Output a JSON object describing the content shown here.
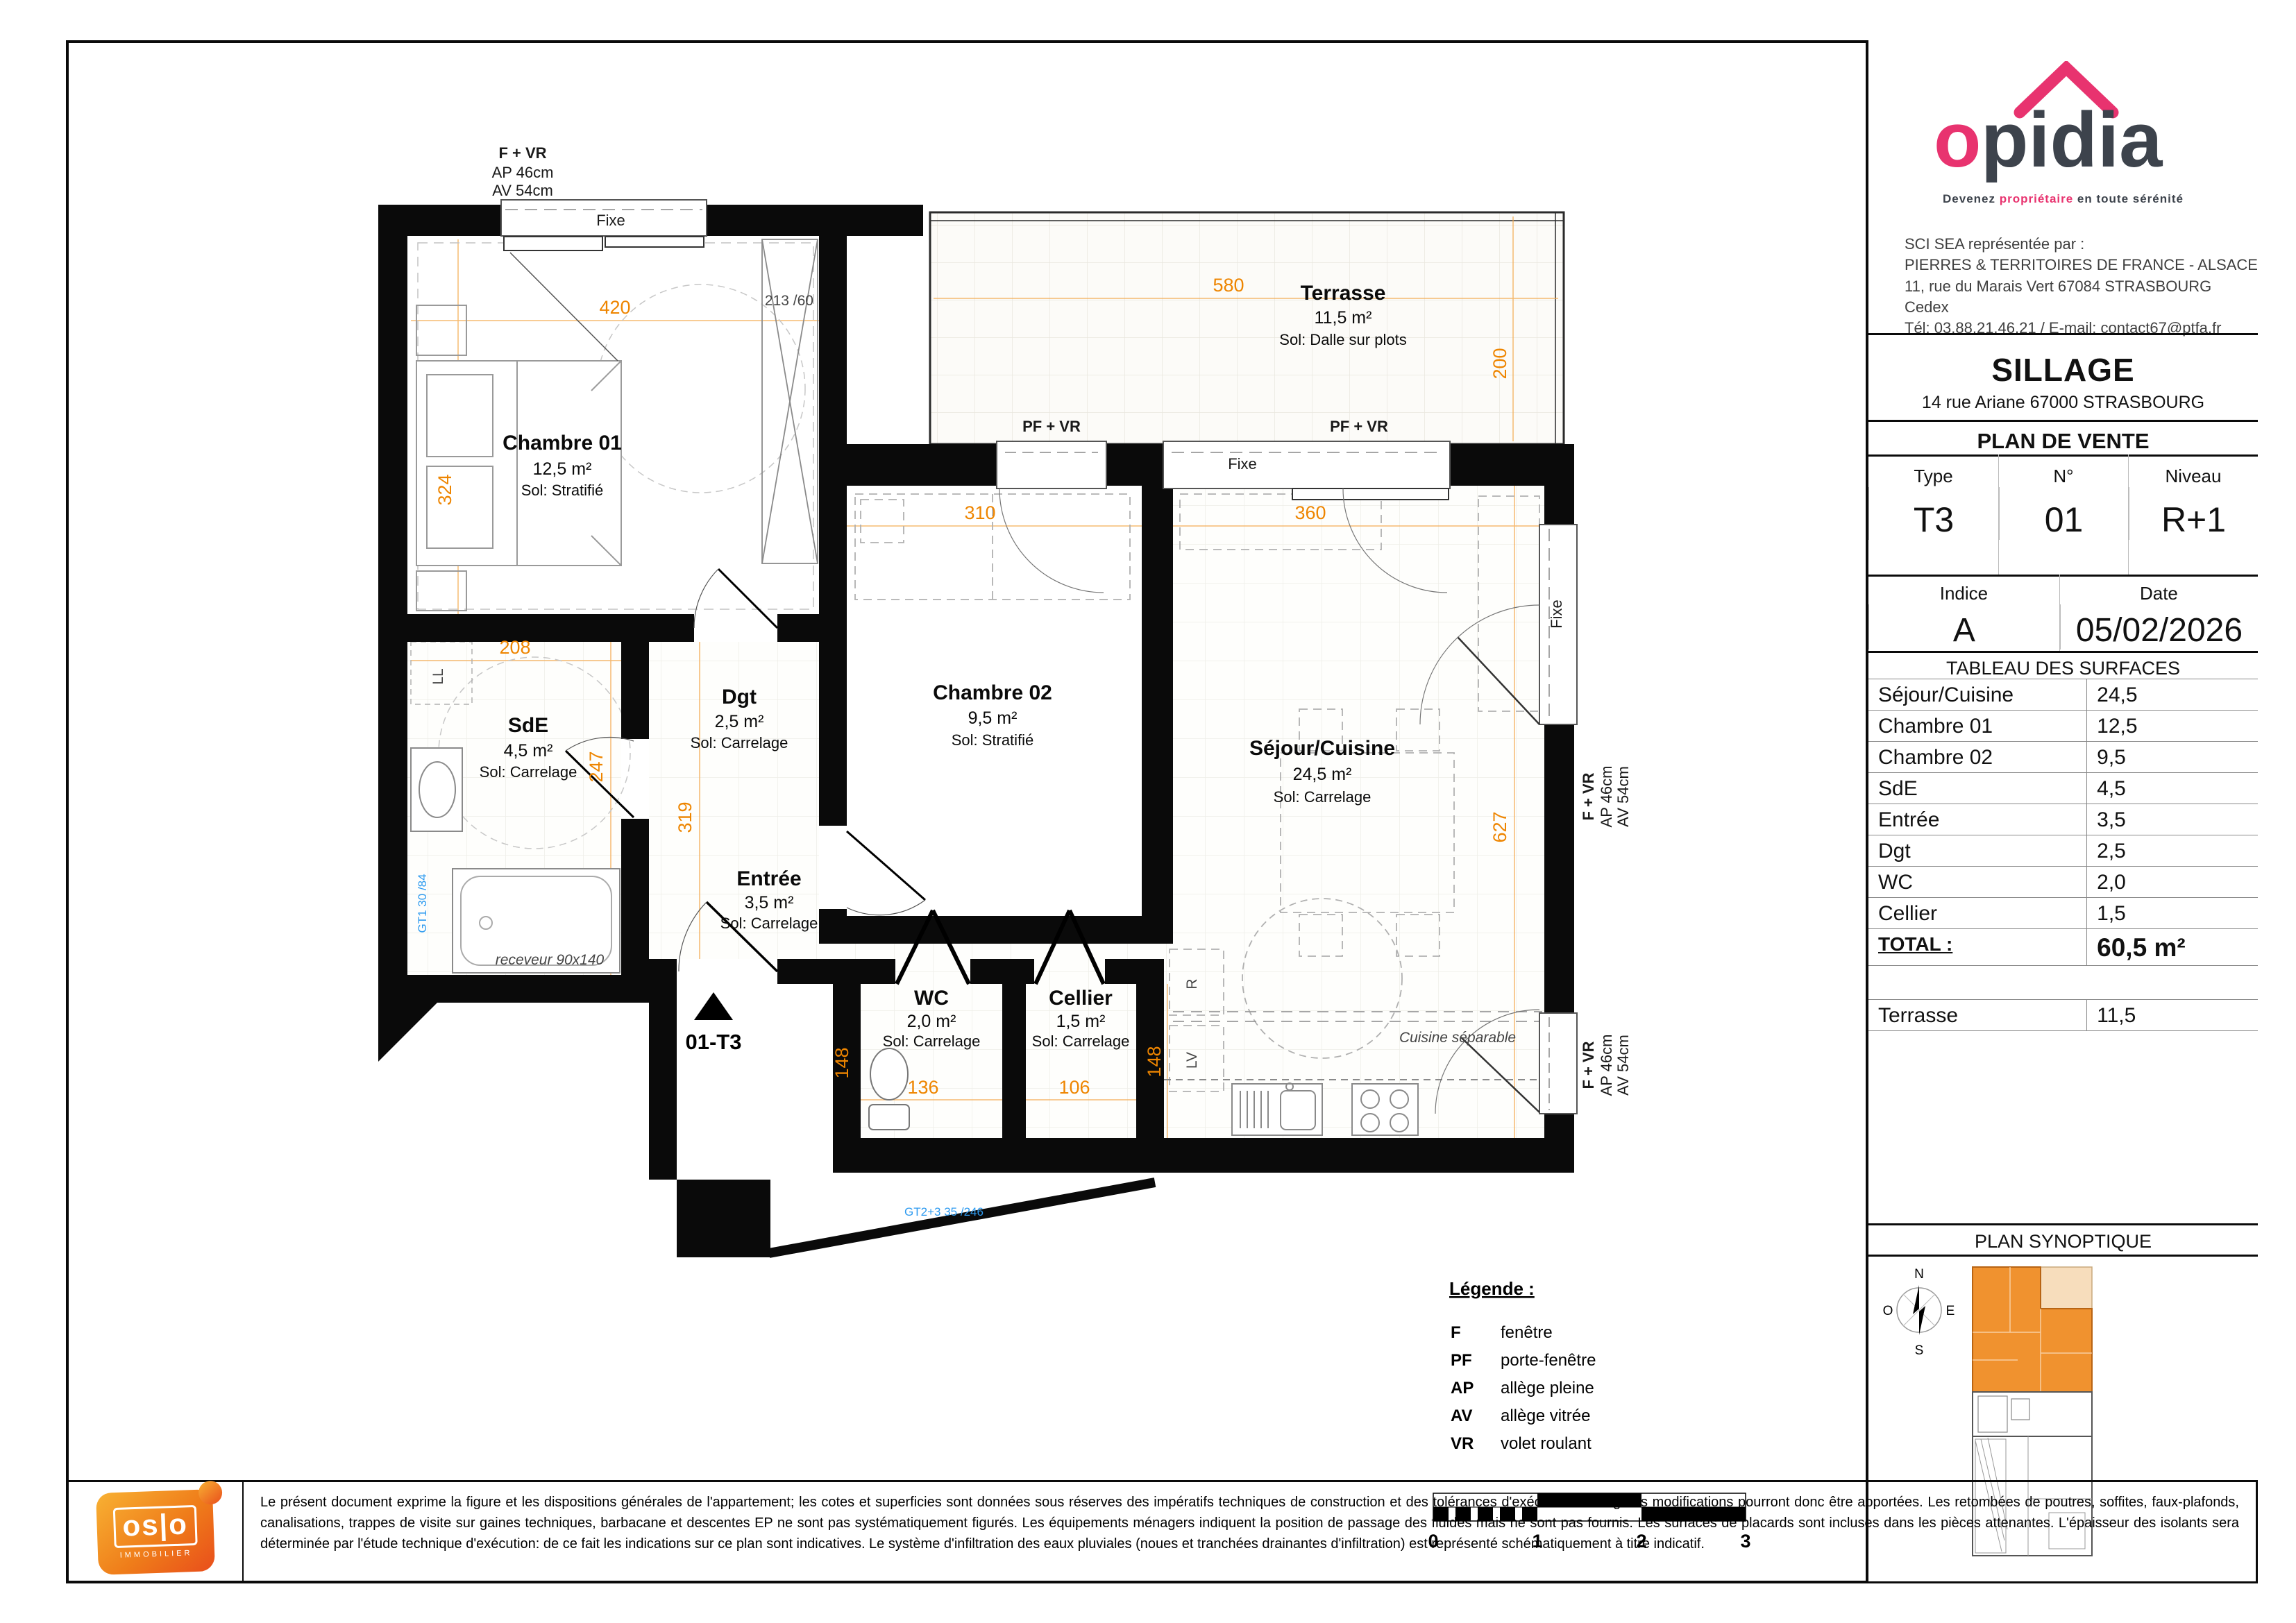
{
  "plan": {
    "window_top": {
      "title": "F + VR",
      "l1": "AP 46cm",
      "l2": "AV 54cm"
    },
    "window_right1": {
      "title": "F + VR",
      "l1": "AP 46cm",
      "l2": "AV 54cm"
    },
    "window_right2": {
      "title": "F + VR",
      "l1": "AP 46cm",
      "l2": "AV 54cm"
    },
    "fixe1": "Fixe",
    "fixe2": "Fixe",
    "fixe3": "Fixe",
    "pf1": "PF + VR",
    "pf2": "PF + VR",
    "rooms": {
      "chambre01": {
        "name": "Chambre 01",
        "area": "12,5 m²",
        "floor": "Sol: Stratifié"
      },
      "chambre02": {
        "name": "Chambre 02",
        "area": "9,5 m²",
        "floor": "Sol: Stratifié"
      },
      "sejour": {
        "name": "Séjour/Cuisine",
        "area": "24,5 m²",
        "floor": "Sol: Carrelage"
      },
      "sde": {
        "name": "SdE",
        "area": "4,5 m²",
        "floor": "Sol: Carrelage"
      },
      "dgt": {
        "name": "Dgt",
        "area": "2,5 m²",
        "floor": "Sol: Carrelage"
      },
      "entree": {
        "name": "Entrée",
        "area": "3,5 m²",
        "floor": "Sol: Carrelage"
      },
      "wc": {
        "name": "WC",
        "area": "2,0 m²",
        "floor": "Sol: Carrelage"
      },
      "cellier": {
        "name": "Cellier",
        "area": "1,5 m²",
        "floor": "Sol: Carrelage"
      },
      "terrasse": {
        "name": "Terrasse",
        "area": "11,5 m²",
        "floor": "Sol: Dalle sur plots"
      }
    },
    "dims": {
      "d420": "420",
      "d324": "324",
      "d580": "580",
      "d200": "200",
      "d310": "310",
      "d360": "360",
      "d208": "208",
      "d247": "247",
      "d319": "319",
      "d627": "627",
      "d148a": "148",
      "d148b": "148",
      "d136": "136",
      "d106": "106",
      "d213": "213 /60"
    },
    "ann": {
      "ll": "LL",
      "r": "R",
      "lv": "LV",
      "gt1": "GT1 30 /84",
      "gt2": "GT2+3 35 /246",
      "receveur": "receveur 90x140",
      "cuisine": "Cuisine séparable",
      "marker": "01-T3"
    }
  },
  "legend": {
    "title": "Légende :",
    "items": [
      {
        "k": "F",
        "v": "fenêtre"
      },
      {
        "k": "PF",
        "v": "porte-fenêtre"
      },
      {
        "k": "AP",
        "v": "allège pleine"
      },
      {
        "k": "AV",
        "v": "allège vitrée"
      },
      {
        "k": "VR",
        "v": "volet roulant"
      }
    ],
    "ticks": [
      "0",
      "1",
      "2",
      "3"
    ]
  },
  "sidebar": {
    "brand": {
      "name_o": "o",
      "name_rest": "pidia",
      "tagline_1": "Devenez ",
      "tagline_hl": "propriétaire",
      "tagline_2": " en toute sérénité",
      "addr": [
        "SCI SEA représentée par :",
        "PIERRES & TERRITOIRES DE FRANCE - ALSACE",
        "11, rue du Marais Vert 67084 STRASBOURG Cedex",
        "Tél: 03.88.21.46.21 / E-mail: contact67@ptfa.fr"
      ]
    },
    "program": {
      "name": "SILLAGE",
      "address": "14 rue Ariane 67000 STRASBOURG"
    },
    "doc_title": "PLAN DE VENTE",
    "meta": {
      "type_label": "Type",
      "type": "T3",
      "num_label": "N°",
      "num": "01",
      "niveau_label": "Niveau",
      "niveau": "R+1",
      "indice_label": "Indice",
      "indice": "A",
      "date_label": "Date",
      "date": "05/02/2026"
    },
    "surfaces": {
      "title": "TABLEAU DES SURFACES",
      "rows": [
        {
          "label": "Séjour/Cuisine",
          "value": "24,5"
        },
        {
          "label": "Chambre 01",
          "value": "12,5"
        },
        {
          "label": "Chambre 02",
          "value": "9,5"
        },
        {
          "label": "SdE",
          "value": "4,5"
        },
        {
          "label": "Entrée",
          "value": "3,5"
        },
        {
          "label": "Dgt",
          "value": "2,5"
        },
        {
          "label": "WC",
          "value": "2,0"
        },
        {
          "label": "Cellier",
          "value": "1,5"
        }
      ],
      "total_label": "TOTAL :",
      "total_value": "60,5 m²",
      "terrasse_label": "Terrasse",
      "terrasse_value": "11,5"
    },
    "synoptique": {
      "title": "PLAN SYNOPTIQUE",
      "compass": {
        "n": "N",
        "s": "S",
        "e": "E",
        "o": "O"
      }
    }
  },
  "footer": {
    "logo": "os|o",
    "logo_sub": "IMMOBILIER",
    "disclaimer": "Le présent document exprime la figure et les dispositions générales de l'appartement; les cotes et superficies sont données sous réserves des impératifs techniques de construction et des tolérances d'exécution. De légères modifications pourront donc être apportées. Les retombées de poutres, soffites, faux-plafonds, canalisations, trappes de visite sur gaines techniques, barbacane et descentes EP ne sont pas systématiquement figurés. Les équipements ménagers indiquent la position de passage des fluides mais ne sont pas fournis. Les surfaces de placards sont incluses dans les pièces attenantes. L'épaisseur des isolants sera déterminée par l'étude technique d'exécution: de ce fait les indications sur ce plan sont indicatives. Le système d'infiltration des eaux pluviales (noues et tranchées drainantes d'infiltration) est représenté schématiquement à titre indicatif."
  }
}
